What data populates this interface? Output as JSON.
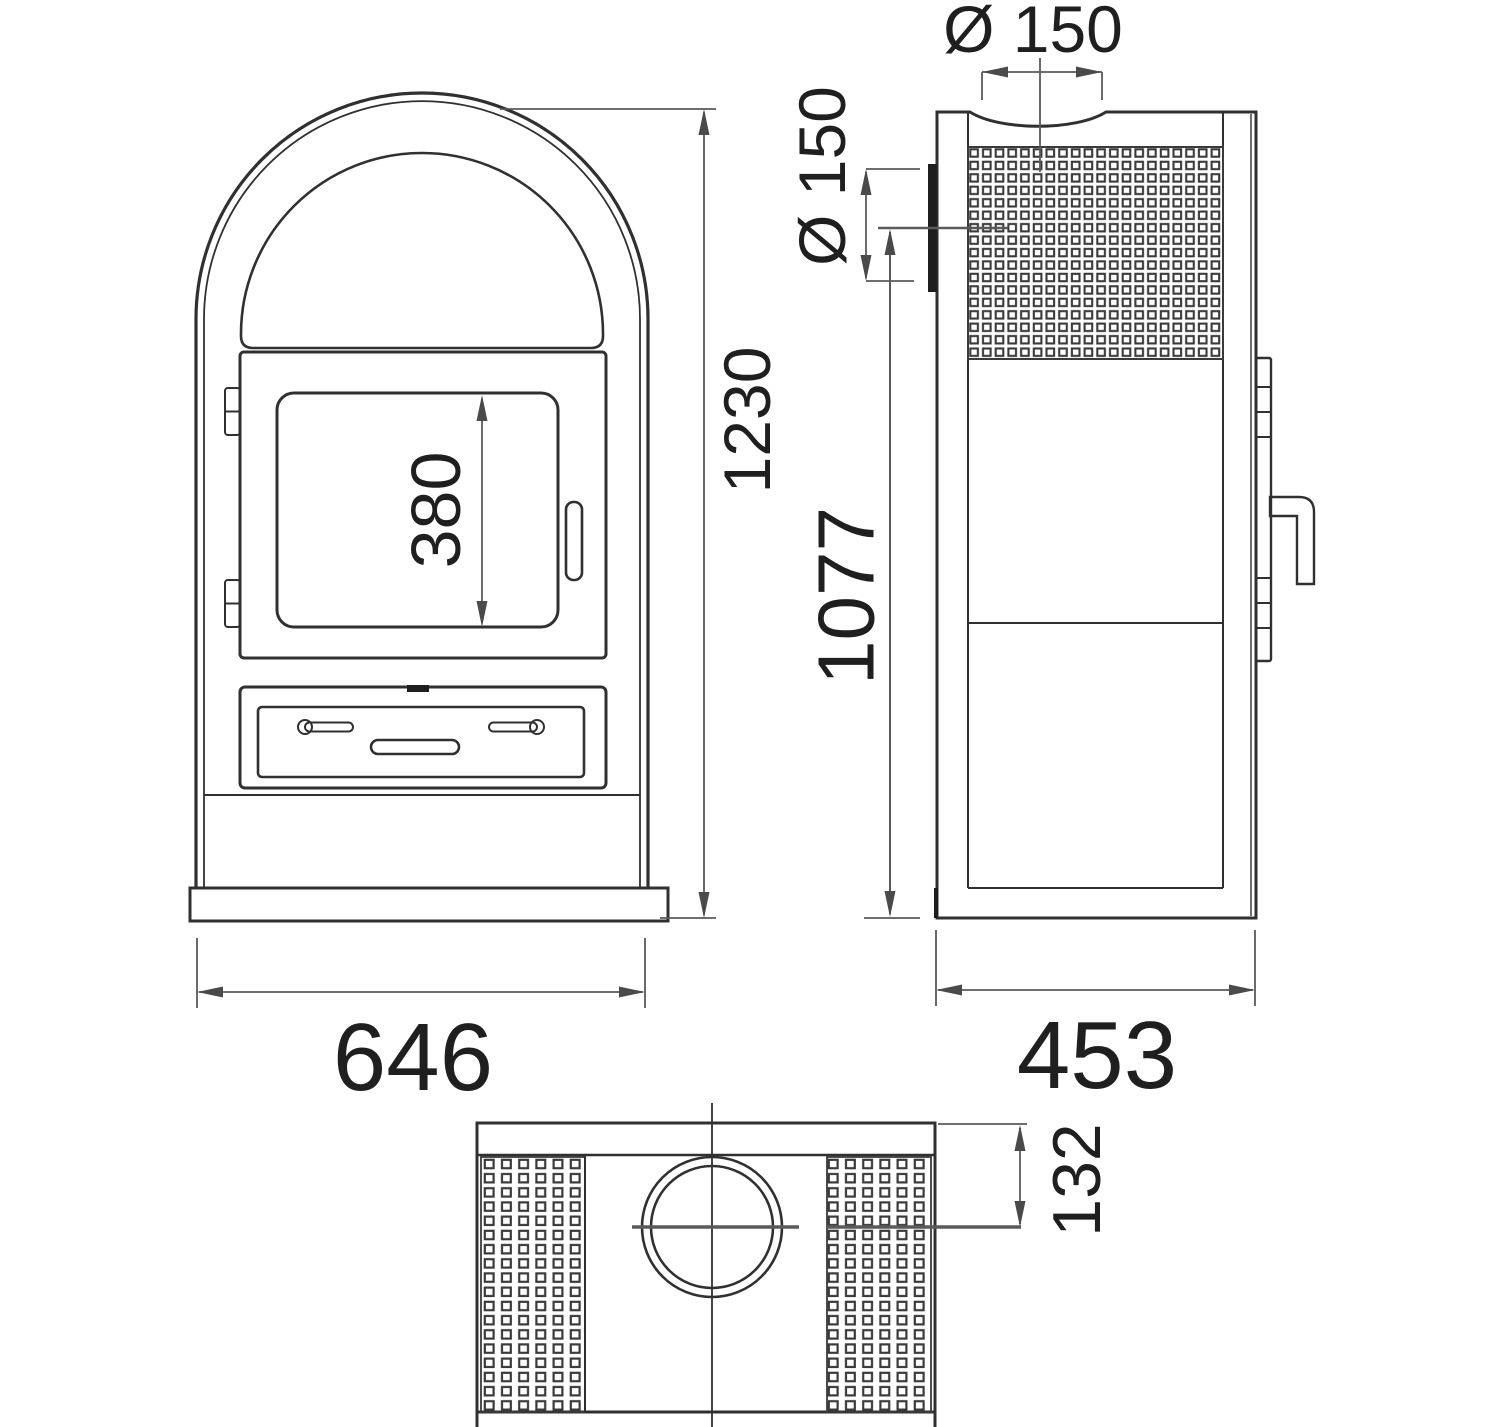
{
  "title": "Wood stove dimensional drawing",
  "views": {
    "front": {
      "name": "front-view",
      "dims": {
        "glass_height": "380",
        "overall_width": "646",
        "overall_height": "1230"
      }
    },
    "side": {
      "name": "side-view",
      "dims": {
        "top_flue_diameter": "Ø 150",
        "rear_flue_diameter": "Ø 150",
        "rear_flue_center_height": "1077",
        "overall_depth": "453"
      }
    },
    "top": {
      "name": "top-view",
      "dims": {
        "flue_center_from_rear": "132"
      }
    }
  },
  "colors": {
    "line": "#303030",
    "dim_line": "#595959",
    "text": "#1f1f1f",
    "background": "#ffffff"
  }
}
